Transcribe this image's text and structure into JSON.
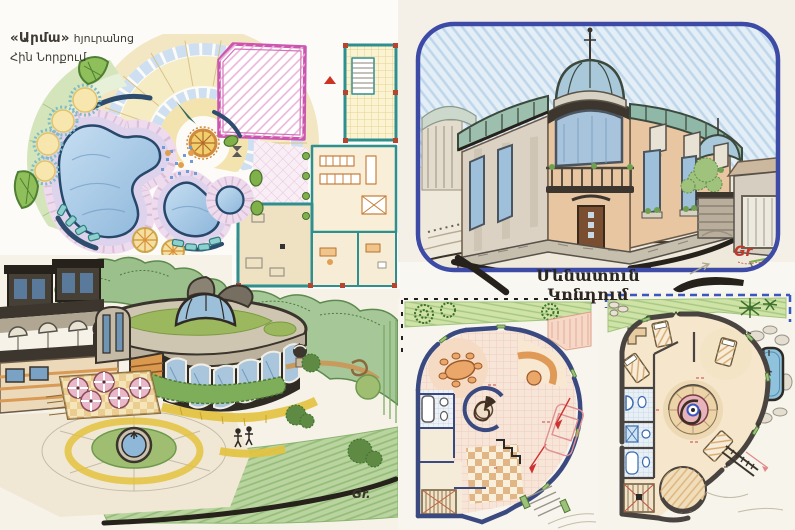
{
  "header": {
    "title_quoted": "«Արմա»",
    "title_suffix": "հյուրանոց",
    "subtitle": "Հին Նորքում"
  },
  "captions": {
    "mansion_plan": "Մենատուն Կոնդում"
  },
  "signatures": {
    "mansion": "Gr",
    "round_building": "Gr."
  },
  "colors": {
    "page_bg": "#f9f7f2",
    "frame_blue": "#3d4aa6",
    "pink_accent": "#cc55b0",
    "pool_blue": "#a9cbe8",
    "pool_outline": "#27476b",
    "wall_navy": "#3a4a80",
    "wall_dark": "#4a4440",
    "teal_wall": "#2e8f8f",
    "lawn_green": "#b6d29c",
    "peach_wall": "#e9c6a2",
    "signature_red": "#c0392b",
    "ink_black": "#26211b"
  }
}
